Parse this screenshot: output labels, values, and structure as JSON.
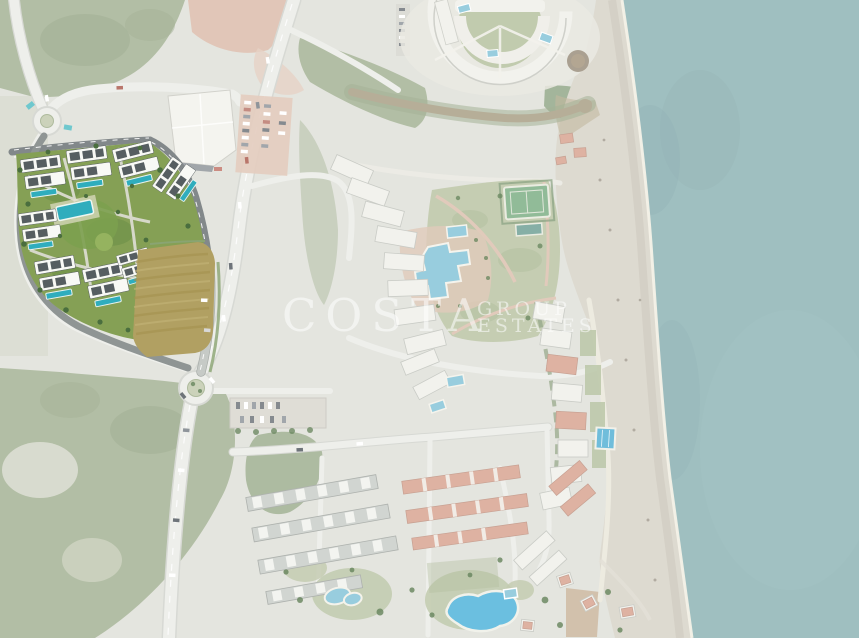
{
  "watermark": {
    "primary": "COSTA",
    "secondary_line1": "GROUP",
    "secondary_line2": "ESTATES"
  },
  "palette": {
    "land": "#dfe0d9",
    "sea": "#8db3b4",
    "beach": "#d7d3c7",
    "forest": "#a4b294",
    "forest_dark": "#93a483",
    "road": "#ebece8",
    "road_dark": "#82888a",
    "dirt": "#dcbcab",
    "field": "#b1a062",
    "lawn": "#b6c19f",
    "building": "#f0f0ea",
    "roof_red": "#d8a491",
    "pool": "#85c4d8",
    "tennis": "#7cae85",
    "dev_grass": "#85a055",
    "dev_pool": "#2fadbd",
    "dev_building": "#f8f9f5",
    "watermark_color": "#ffffff"
  }
}
